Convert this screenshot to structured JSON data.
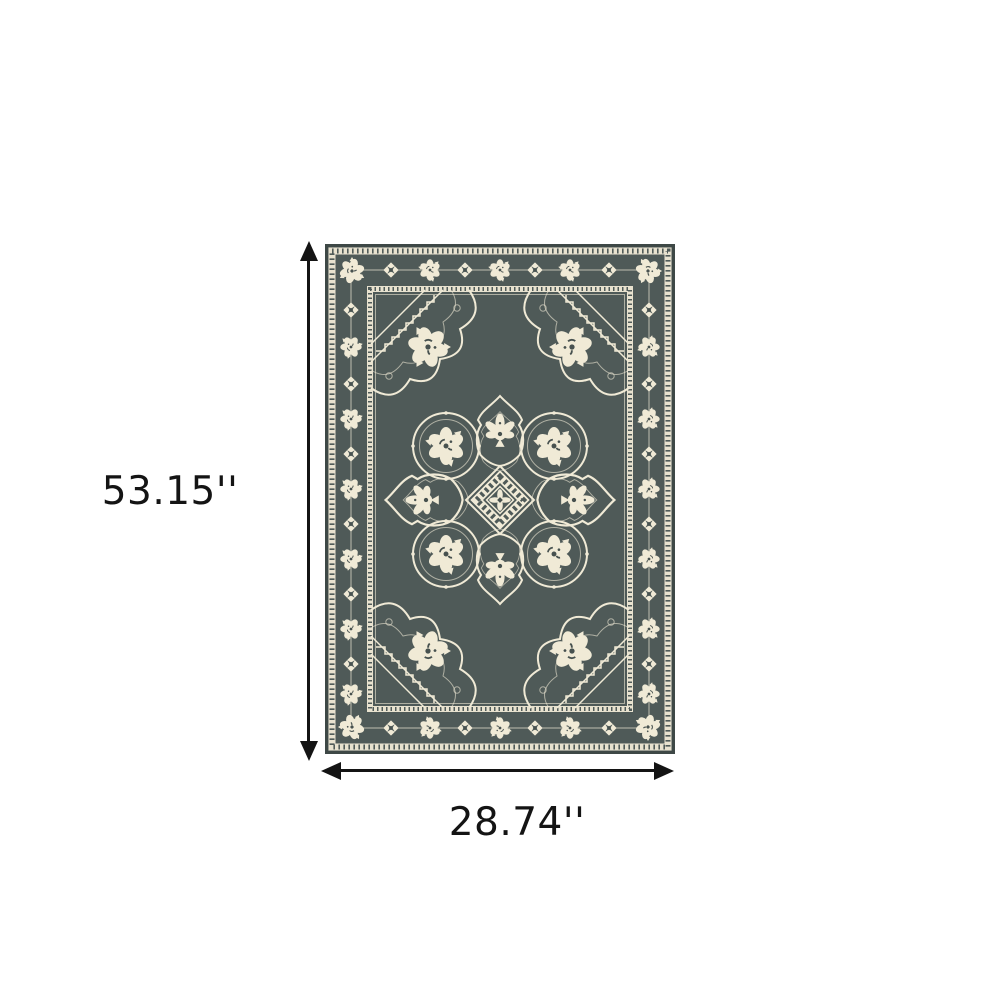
{
  "image": {
    "kind": "product-dimension-diagram",
    "subject": "gray and ivory oriental medallion area rug"
  },
  "dimensions": {
    "height_label": "53.15''",
    "width_label": "28.74''"
  },
  "colors": {
    "background": "#ffffff",
    "arrow": "#141414",
    "label_text": "#141414",
    "rug_field": "#4f5a58",
    "rug_edge": "#3e4846",
    "rug_ivory": "#f0ead6",
    "rug_band": "#e8e2cf",
    "rug_dark_detail": "#47514f"
  }
}
